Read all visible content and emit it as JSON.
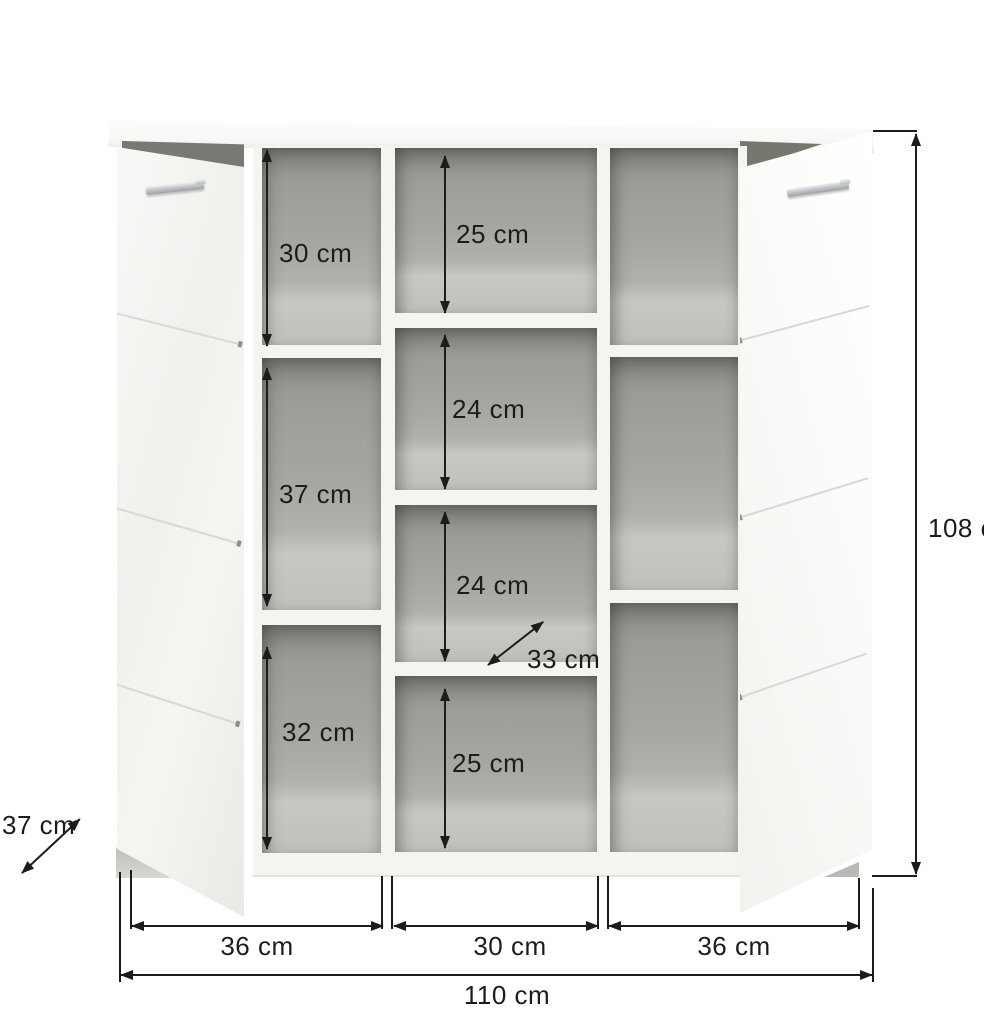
{
  "diagram": {
    "subject": "sideboard with two open doors and shelf compartments",
    "unit": "cm",
    "overall_width": {
      "label": "110 cm",
      "value": 110
    },
    "overall_height": {
      "label": "108 cm",
      "value": 108
    },
    "cabinet_depth": {
      "label": "37 cm",
      "value": 37
    },
    "shelf_depth": {
      "label": "33 cm",
      "value": 33
    },
    "section_widths": [
      {
        "label": "36 cm",
        "value": 36
      },
      {
        "label": "30 cm",
        "value": 30
      },
      {
        "label": "36 cm",
        "value": 36
      }
    ],
    "left_column_cell_heights": [
      {
        "label": "30 cm",
        "value": 30
      },
      {
        "label": "37 cm",
        "value": 37
      },
      {
        "label": "32 cm",
        "value": 32
      }
    ],
    "middle_column_cell_heights": [
      {
        "label": "25 cm",
        "value": 25
      },
      {
        "label": "24 cm",
        "value": 24
      },
      {
        "label": "24 cm",
        "value": 24
      },
      {
        "label": "25 cm",
        "value": 25
      }
    ],
    "colors": {
      "background": "#ffffff",
      "dimension_line": "#1c1c1c",
      "interior_gray": "#a5a69f",
      "carcass_white": "#f4f4f1"
    }
  }
}
